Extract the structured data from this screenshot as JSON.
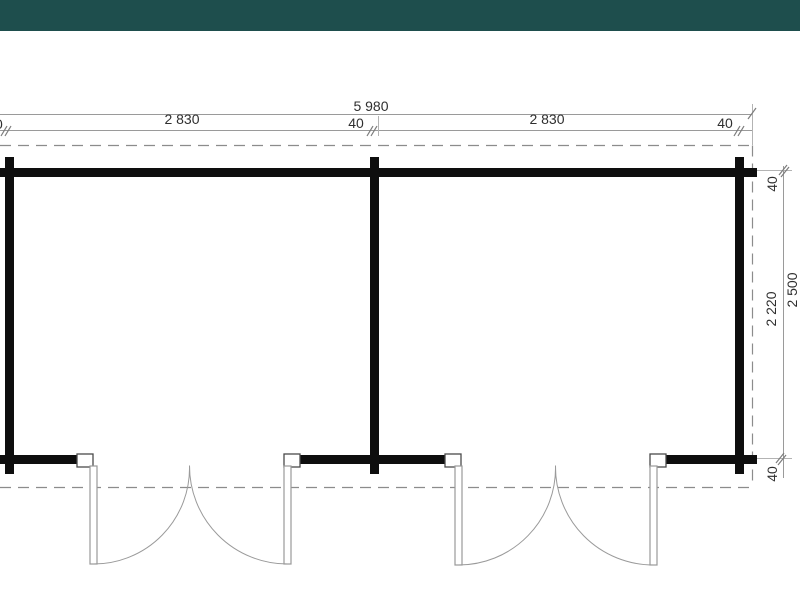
{
  "header": {
    "bar_color": "#1e4e4d"
  },
  "floor_plan": {
    "line_colors": {
      "wall": "#0e0e0e",
      "dimension_line": "#9a9a9a",
      "dashed_outline": "#8c8c8c",
      "door_line": "#9a9a9a",
      "tick": "#7d7d7d"
    },
    "dimensions_top": {
      "overall_width": "5 980",
      "seg_40_left_cropped": "40",
      "seg_2830_left": "2 830",
      "seg_40_middle": "40",
      "seg_2830_right": "2 830",
      "seg_40_right": "40"
    },
    "dimensions_right": {
      "seg_40_top": "40",
      "seg_2220": "2 220",
      "overall_height": "2 500",
      "seg_40_bottom": "40"
    }
  }
}
